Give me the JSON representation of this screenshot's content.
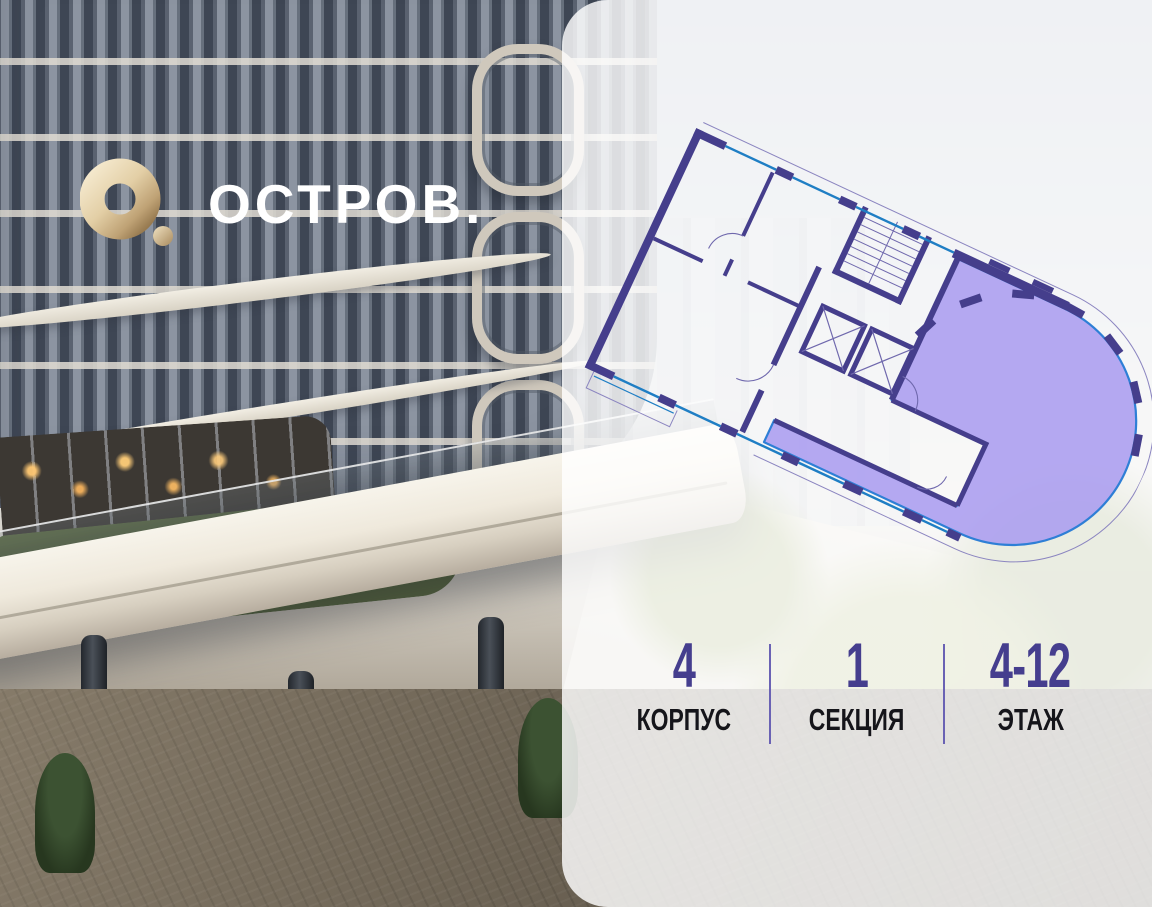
{
  "brand": {
    "name": "ОСТРОВ.",
    "logo_icon": "gold-ring-with-dot",
    "logo_gold_light": "#F2E4C4",
    "logo_gold_dark": "#9C8055",
    "text_color": "#FFFFFF"
  },
  "floor_plan": {
    "rotation_deg": 25,
    "wall_color": "#453E8C",
    "window_color": "#1F7EC4",
    "thin_line_color": "#8B85C0",
    "highlight_fill": "#A89AF0",
    "highlight_outline": "#2E7FD6",
    "highlighted_unit": "corner-apartment-with-rounded-end"
  },
  "info_panel": {
    "background": "rgba(255,255,255,0.82)",
    "value_color": "#453E8E",
    "label_color": "#15151A",
    "divider_color": "#6A62B4",
    "items": [
      {
        "value": "4",
        "label": "КОРПУС"
      },
      {
        "value": "1",
        "label": "СЕКЦИЯ"
      },
      {
        "value": "4-12",
        "label": "ЭТАЖ"
      }
    ]
  }
}
